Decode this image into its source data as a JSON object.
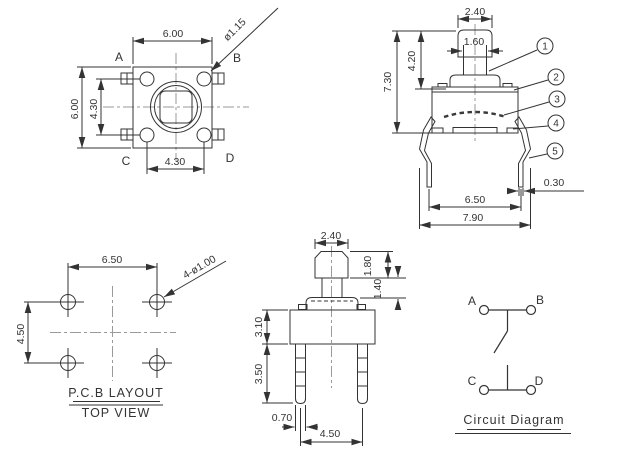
{
  "colors": {
    "line": "#333333",
    "centerline": "#9a9a9a",
    "background": "#ffffff",
    "text": "#333333"
  },
  "views": {
    "top_view": {
      "corner_labels": {
        "a": "A",
        "b": "B",
        "c": "C",
        "d": "D"
      },
      "dims": {
        "width_top": "6.00",
        "height_left": "6.00",
        "pin_span_vertical": "4.30",
        "pin_span_bottom": "4.30",
        "button_diameter": "ø1.15"
      }
    },
    "side_view": {
      "dims": {
        "cap_width": "2.40",
        "stem_width": "1.60",
        "actuator_height": "4.20",
        "total_height": "7.30",
        "leg_thickness": "0.30",
        "leg_span_inner": "6.50",
        "leg_span_outer": "7.90"
      },
      "callouts": [
        {
          "id": "1"
        },
        {
          "id": "2"
        },
        {
          "id": "3"
        },
        {
          "id": "4"
        },
        {
          "id": "5"
        }
      ]
    },
    "pcb_layout": {
      "title": "P.C.B LAYOUT",
      "subtitle": "TOP VIEW",
      "dims": {
        "hole_span_horizontal": "6.50",
        "hole_span_vertical": "4.50",
        "hole_callout": "4-ø1.00"
      }
    },
    "front_view": {
      "dims": {
        "cap_width": "2.40",
        "cap_height": "1.80",
        "stem_height": "1.40",
        "body_height": "3.10",
        "pin_length": "3.50",
        "pin_width": "0.70",
        "pin_span": "4.50"
      }
    },
    "circuit_diagram": {
      "title": "Circuit Diagram",
      "terminal_labels": {
        "a": "A",
        "b": "B",
        "c": "C",
        "d": "D"
      }
    }
  }
}
